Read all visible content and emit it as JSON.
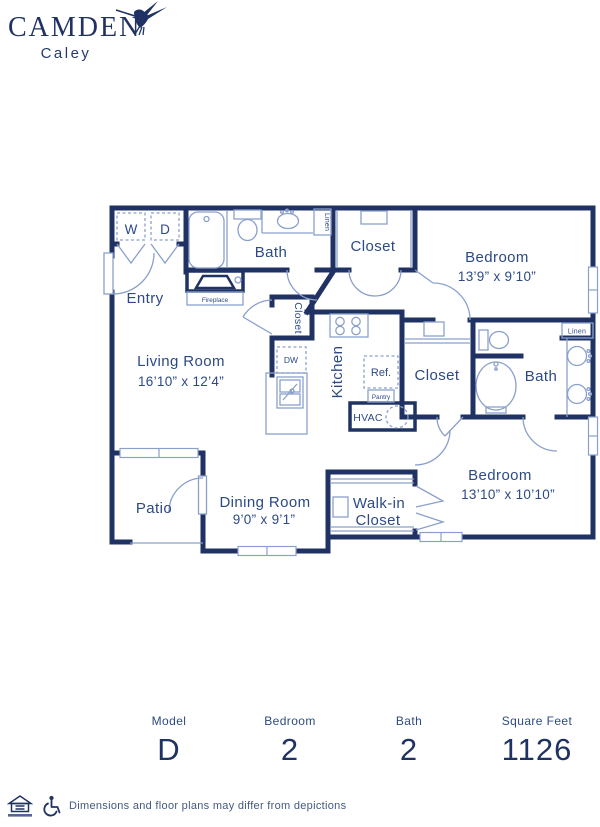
{
  "brand": {
    "name": "CAMDEN",
    "community": "Caley"
  },
  "colors": {
    "navy": "#1f3263",
    "light_line": "#8aa0cb",
    "label_text": "#2d4a85"
  },
  "plan": {
    "entry": "Entry",
    "washer": "W",
    "dryer": "D",
    "bath1": "Bath",
    "linen1": "Linen",
    "fireplace": "Fireplace",
    "closet_top": "Closet",
    "bedroom1_name": "Bedroom",
    "bedroom1_dims": "13’9” x 9’10”",
    "living_name": "Living Room",
    "living_dims": "16’10” x 12’4”",
    "hall_closet": "Closet",
    "kitchen": "Kitchen",
    "dw": "DW",
    "ref": "Ref.",
    "pantry": "Pantry",
    "hvac": "HVAC",
    "closet2": "Closet",
    "bath2": "Bath",
    "linen2": "Linen",
    "patio": "Patio",
    "dining_name": "Dining  Room",
    "dining_dims": "9’0” x 9’1”",
    "walkin_line1": "Walk-in",
    "walkin_line2": "Closet",
    "bedroom2_name": "Bedroom",
    "bedroom2_dims": "13’10” x 10’10”"
  },
  "stats": {
    "items": [
      {
        "label": "Model",
        "value": "D"
      },
      {
        "label": "Bedroom",
        "value": "2"
      },
      {
        "label": "Bath",
        "value": "2"
      },
      {
        "label": "Square Feet",
        "value": "1126"
      }
    ]
  },
  "footer": {
    "disclaimer": "Dimensions and floor plans may differ from depictions"
  }
}
